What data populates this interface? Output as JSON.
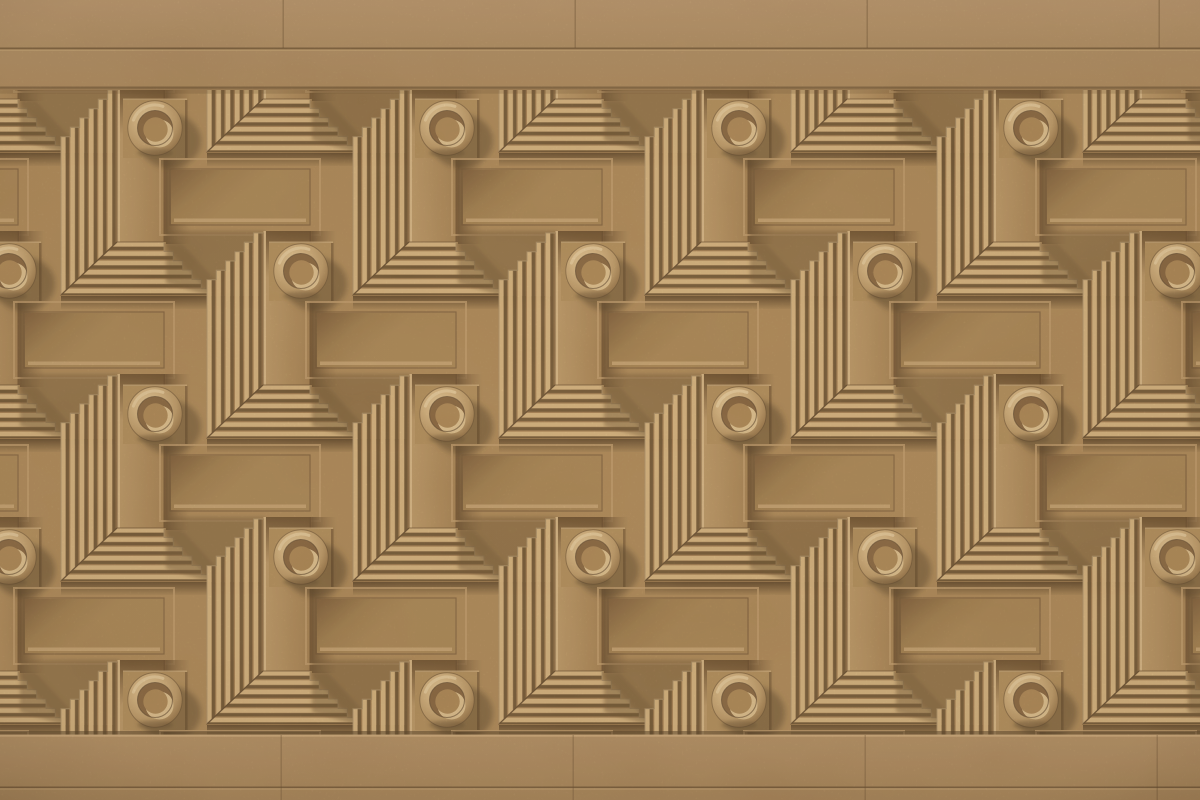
{
  "meta": {
    "description": "Close-up photograph of a sand-colored cast-stone relief wall in strong sunlight. A plain travertine band runs across the top and bottom; between them is a deep geometric relief: staggered rows of round doughnut-shaped bosses with recessed bowls, L-shaped fluted chevrons with stepped mitered ends, smooth pilaster strips and sunken framed panels, all repeating diagonally. Light rakes from the upper left, casting hard shadows down and to the right.",
    "scene_type": "architectural relief facade, no text or UI elements",
    "lighting": "warm sunlight from upper-left; bright ridge faces, deep brown grooves and cast shadows"
  },
  "palette": {
    "base": "#b28d5c",
    "baseLight": "#c09c6c",
    "baseDark": "#9d7b4e",
    "ridgeLight": "#dfbc87",
    "ridgeMid": "#a98356",
    "ridgeDark": "#6f5434",
    "recess": "#6d5233",
    "lineDark": "#5e462b",
    "edgeLight": "#ecd0a0",
    "panelFace": "#ad8958",
    "panelShade": "#7d5c3a",
    "plinth": "#b6925f",
    "ringLight": "#ecd2a2",
    "ringBase": "#bd9a69",
    "ringDark": "#8f6c42",
    "bowlShade": "#876540",
    "bowlFloor": "#b08a58",
    "crescent": "#e6c997",
    "shadow": "#43311c",
    "bandTop": "#bb9870",
    "bandLow": "#ad8a5d"
  },
  "geometry": {
    "image_width": 1200,
    "image_height": 800,
    "top_band": {
      "top": 0,
      "bottom": 90,
      "joint_line_y": 48
    },
    "bottom_band": {
      "top": 735,
      "bottom": 800,
      "joint_line_y": 787
    },
    "band_vertical_joints_x": [
      283,
      575,
      867,
      1159
    ],
    "relief_field": {
      "top": 90,
      "bottom": 735
    },
    "tile": {
      "width": 292,
      "height": 286,
      "origin_x": 8,
      "origin_y": 90
    },
    "motif_stagger": [
      146,
      143
    ],
    "boss": {
      "outer_radius": 27,
      "bowl_radius": 17.5,
      "first_center": [
        155,
        128
      ],
      "row_y_centers": [
        128,
        271,
        414,
        557,
        700
      ],
      "columns_odd_rows_x": [
        155,
        447,
        739,
        1031
      ],
      "columns_even_rows_x": [
        9,
        301,
        593,
        885,
        1177
      ],
      "visible_count": 22
    },
    "chevron": {
      "flute_count": 6,
      "flute_period_px": 9.33,
      "band_width": 56,
      "arm_style": "mitered corner, staircase-stepped ends"
    },
    "framed_panel": {
      "width": 160,
      "height": 76
    },
    "pilaster_strip": {
      "width": 46,
      "height": 154
    }
  }
}
